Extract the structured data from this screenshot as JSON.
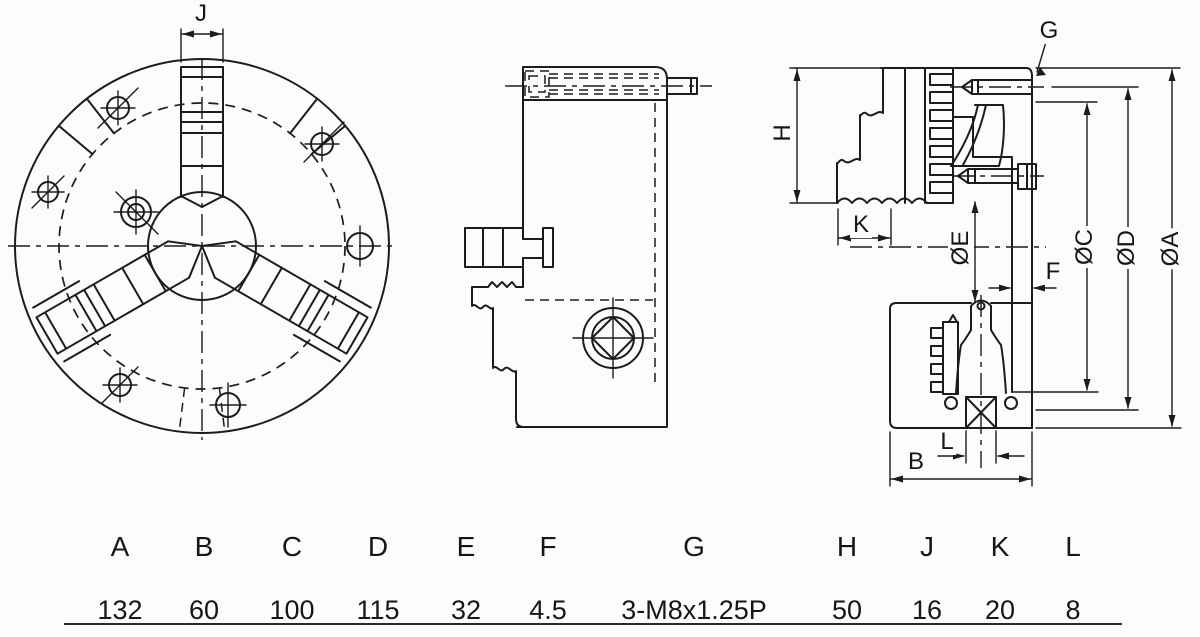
{
  "drawing_title": "3-jaw-scroll-chuck-technical-drawing",
  "colors": {
    "line": "#1c1c1c",
    "background": "#fcfcfc"
  },
  "dimensions": {
    "J": "J",
    "G": "G",
    "H": "H",
    "K": "K",
    "E": "ØE",
    "F": "F",
    "C": "ØC",
    "D": "ØD",
    "A": "ØA",
    "L": "L",
    "B": "B"
  },
  "table": {
    "columns": [
      {
        "label": "A",
        "value": "132"
      },
      {
        "label": "B",
        "value": "60"
      },
      {
        "label": "C",
        "value": "100"
      },
      {
        "label": "D",
        "value": "115"
      },
      {
        "label": "E",
        "value": "32"
      },
      {
        "label": "F",
        "value": "4.5"
      },
      {
        "label": "G",
        "value": "3-M8x1.25P"
      },
      {
        "label": "H",
        "value": "50"
      },
      {
        "label": "J",
        "value": "16"
      },
      {
        "label": "K",
        "value": "20"
      },
      {
        "label": "L",
        "value": "8"
      }
    ]
  }
}
